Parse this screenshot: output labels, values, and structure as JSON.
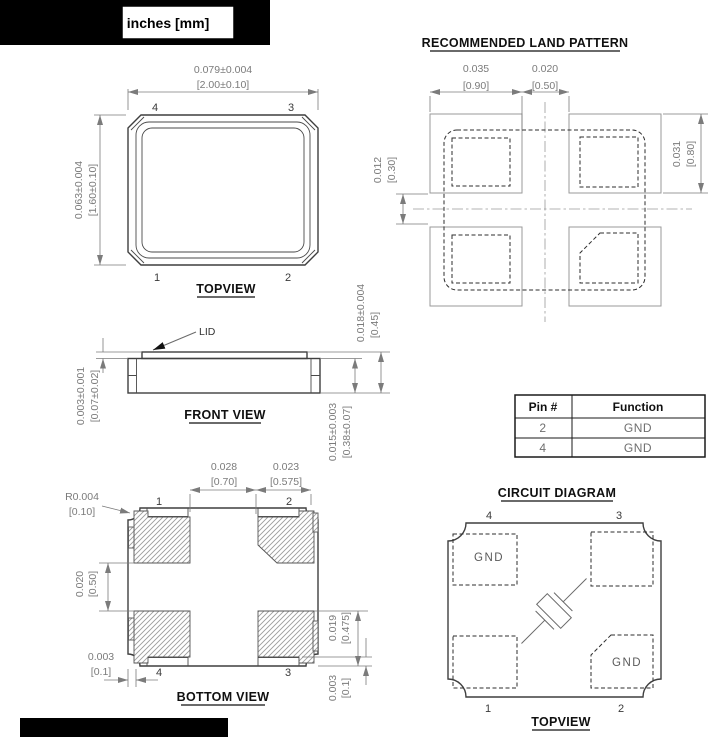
{
  "page": {
    "units_label": "inches [mm]"
  },
  "top_view": {
    "title": "TOPVIEW",
    "width_in": "0.079±0.004",
    "width_mm": "[2.00±0.10]",
    "height_in": "0.063±0.004",
    "height_mm": "[1.60±0.10]",
    "pin_top_left": "4",
    "pin_top_right": "3",
    "pin_bottom_left": "1",
    "pin_bottom_right": "2"
  },
  "land_pattern": {
    "title": "RECOMMENDED LAND PATTERN",
    "pad_width_in": "0.035",
    "pad_width_mm": "[0.90]",
    "pad_gap_in": "0.020",
    "pad_gap_mm": "[0.50]",
    "row_gap_in": "0.012",
    "row_gap_mm": "[0.30]",
    "pad_height_in": "0.031",
    "pad_height_mm": "[0.80]"
  },
  "front_view": {
    "title": "FRONT VIEW",
    "lid_label": "LID",
    "lid_thickness_in": "0.003±0.001",
    "lid_thickness_mm": "[0.07±0.02]",
    "total_height_in": "0.018±0.004",
    "total_height_mm": "[0.45]",
    "body_height_in": "0.015±0.003",
    "body_height_mm": "[0.38±0.07]"
  },
  "pin_table": {
    "headers": [
      "Pin #",
      "Function"
    ],
    "rows": [
      [
        "2",
        "GND"
      ],
      [
        "4",
        "GND"
      ]
    ]
  },
  "circuit_diagram": {
    "title": "CIRCUIT DIAGRAM",
    "subtitle": "TOPVIEW",
    "pin_top_left": "4",
    "pin_top_right": "3",
    "pin_bottom_left": "1",
    "pin_bottom_right": "2",
    "gnd_top_left": "GND",
    "gnd_bottom_right": "GND"
  },
  "bottom_view": {
    "title": "BOTTOM VIEW",
    "pad_pitch_in": "0.028",
    "pad_pitch_mm": "[0.70]",
    "pad_width_in": "0.023",
    "pad_width_mm": "[0.575]",
    "corner_radius_in": "R0.004",
    "corner_radius_mm": "[0.10]",
    "pad_gap_in": "0.020",
    "pad_gap_mm": "[0.50]",
    "edge_margin_in": "0.003",
    "edge_margin_mm": "[0.1]",
    "pad_height_in": "0.019",
    "pad_height_mm": "[0.475]",
    "bottom_margin_in": "0.003",
    "bottom_margin_mm": "[0.1]",
    "pin_top_left": "1",
    "pin_top_right": "2",
    "pin_bottom_left": "4",
    "pin_bottom_right": "3"
  },
  "colors": {
    "dim_line": "#7b7b7b",
    "outline": "#3f3f3f",
    "title_text": "#101010",
    "redaction": "#000000"
  }
}
